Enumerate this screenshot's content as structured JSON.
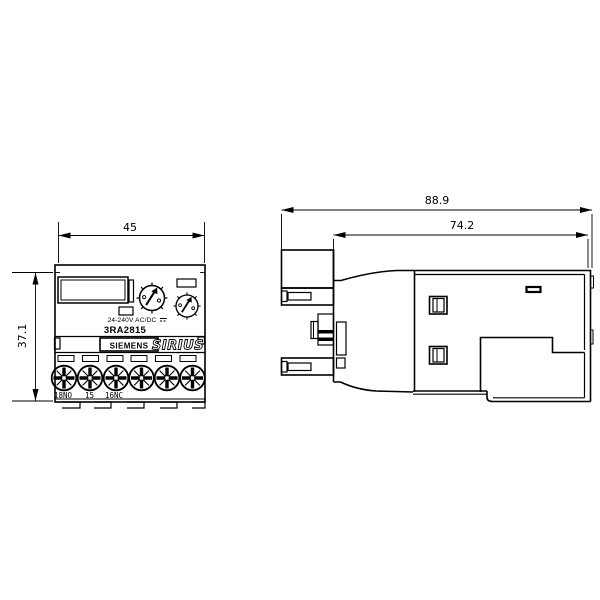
{
  "page": {
    "background": "#ffffff",
    "line_color": "#000000",
    "description_title": "Siemens SIRIUS dimensional drawing"
  },
  "front_view": {
    "width_dim": "45",
    "height_dim": "37.1",
    "rating_label": "24-240V AC/DC",
    "model_number": "3RA2815",
    "brand_label": "SIEMENS",
    "series_label": "SIRIUS",
    "terminals": [
      "18NO",
      "15",
      "16NC"
    ]
  },
  "side_view": {
    "overall_depth_dim": "88.9",
    "mounting_depth_dim": "74.2"
  }
}
